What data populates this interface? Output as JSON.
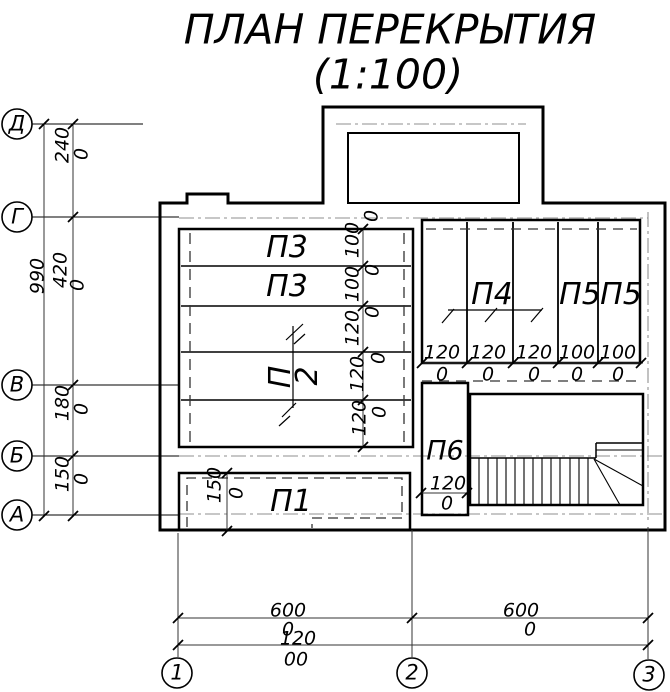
{
  "title": {
    "line1": "ПЛАН ПЕРЕКРЫТИЯ",
    "line2": "(1:100)"
  },
  "row_axes": [
    {
      "label": "Д"
    },
    {
      "label": "Г"
    },
    {
      "label": "В"
    },
    {
      "label": "Б"
    },
    {
      "label": "А"
    }
  ],
  "col_axes": [
    {
      "label": "1"
    },
    {
      "label": "2"
    },
    {
      "label": "3"
    }
  ],
  "left_dims": {
    "total_main": "990",
    "seg_dg_main": "240",
    "seg_dg_tail": "0",
    "seg_gv_main": "420",
    "seg_gv_tail": "0",
    "seg_vb_main": "180",
    "seg_vb_tail": "0",
    "seg_ba_main": "150",
    "seg_ba_tail": "0"
  },
  "slab_rows": [
    {
      "main": "100",
      "tail": "0"
    },
    {
      "main": "100",
      "tail": "0"
    },
    {
      "main": "120",
      "tail": "0"
    },
    {
      "main": "120",
      "tail": "0"
    },
    {
      "main": "120",
      "tail": "0"
    }
  ],
  "slab_cols": [
    {
      "main": "120",
      "tail": "0"
    },
    {
      "main": "120",
      "tail": "0"
    },
    {
      "main": "120",
      "tail": "0"
    },
    {
      "main": "100",
      "tail": "0"
    },
    {
      "main": "100",
      "tail": "0"
    }
  ],
  "bottom_dims": {
    "span1_main": "600",
    "span1_tail": "0",
    "span2_main": "600",
    "span2_tail": "0",
    "total_main": "120",
    "total_tail": "00"
  },
  "p1_dim": {
    "main": "150",
    "tail": "0"
  },
  "p6_dim": {
    "main": "120",
    "tail": "0"
  },
  "labels": {
    "p1": "П1",
    "p2_c1": "П",
    "p2_c2": "2",
    "p3_1": "П3",
    "p3_2": "П3",
    "p4": "П4",
    "p5_1": "П5",
    "p5_2": "П5",
    "p6": "П6"
  },
  "colors": {
    "wall": "#000000",
    "axis_dashdot": "#8f8f8f",
    "hidden_dash": "#333333"
  }
}
